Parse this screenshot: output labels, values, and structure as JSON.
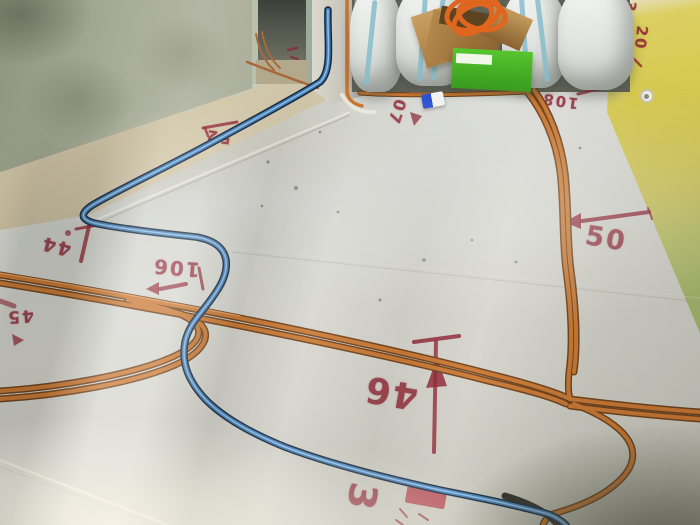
{
  "scene": {
    "description": "Room under renovation: insulation boards on floor, orange and blue electrical conduits, red stenciled level numbers, storage sacks and boxes at back wall"
  },
  "colors": {
    "conduit_orange": "#c9742c",
    "conduit_orange_dark": "#6b3c16",
    "conduit_orange_hi": "#efa968",
    "conduit_blue": "#3f7cb5",
    "conduit_blue_dark": "#15253a",
    "conduit_blue_hi": "#9cc8ec",
    "conduit_copper": "#a8683a",
    "stencil_red": "#8e2130",
    "floor_board": "#cfd0ca",
    "wall_left_green": "#a6ab97",
    "wall_right_yellow": "#d6c94f",
    "sack_white": "#eef0ee",
    "sack_stripe_blue": "#7fb8cc",
    "cardboard": "#b5894e",
    "green_box": "#4db52a",
    "coil_orange": "#e0661f"
  },
  "stencils": {
    "s52": {
      "text": "52"
    },
    "s44": {
      "text": "44"
    },
    "s45": {
      "text": "45"
    },
    "s106": {
      "text": "106"
    },
    "s107": {
      "text": "107"
    },
    "s108": {
      "text": "108"
    },
    "s50": {
      "text": "50"
    },
    "s46": {
      "text": "46"
    },
    "floor_3": {
      "text": "3"
    },
    "wall_20": {
      "text": "20"
    },
    "wall_3": {
      "text": "3"
    }
  }
}
